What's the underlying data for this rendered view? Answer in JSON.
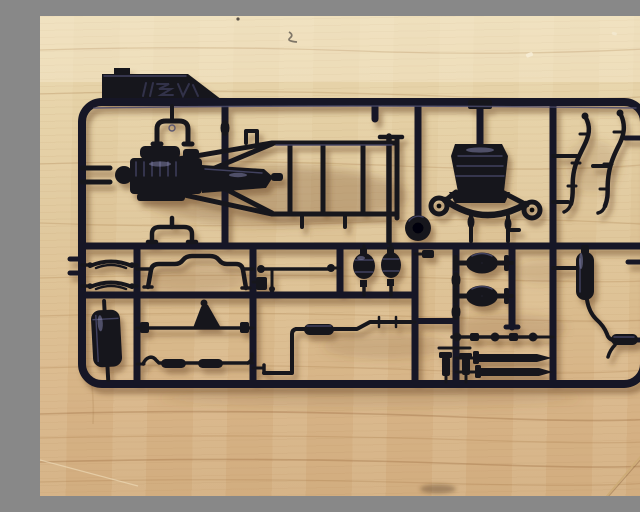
{
  "scene": {
    "type": "photograph",
    "description": "Top-down photo of a black injection-molded model kit sprue (parts runner) for a pickup truck chassis, lying on a light plywood workbench",
    "wood_surface": {
      "material": "plywood with horizontal grain",
      "base_color": "#dcc096",
      "grain_color": "#b98f58",
      "marks": {
        "pencil_squiggle": "small grey pencil squiggle near top centre",
        "tiny_dot": "tiny dark dot at top edge",
        "white_speck_1": "tiny white paint speck upper right",
        "white_speck_2": "tiny white speck near top right",
        "bottom_smudge": "dark smudge at bottom centre",
        "diagonal_crease": "diagonal grain crease in lower-right corner",
        "light_scratch": "faint light scratch in lower-left corner"
      }
    },
    "sprue": {
      "plastic_color": "#16161f",
      "highlight_color": "#4a4a6b",
      "frame": "rounded-rectangle outer runner with internal cross runners dividing part cells",
      "logo_tab": {
        "description": "molded manufacturer logo tab with stylized embossed italic lettering, same black plastic",
        "position": "top-left"
      },
      "parts": {
        "chassis_frame": "ladder chassis frame with crossmembers and diagonal braces",
        "engine_assembly": "engine block with ribbed head, intake and transmission tail",
        "spring_shackle_upper": "U-shaped spring shackle bracket above engine",
        "spring_shackle_lower": "lower shackle bracket near centre runner",
        "transfer_case": "transfer case box with looped crossmember ears and two lever pins",
        "diff_cover_dome": "round differential cover dome",
        "flex_pipe_left": "curved brake/fuel pipe with clamp stubs",
        "flex_pipe_right": "curved brake/fuel pipe with clamp stubs",
        "leaf_spring_1": "short leaf spring with eye ends",
        "leaf_spring_2": "short leaf spring with eye ends",
        "fuel_tank": "tall rounded fuel tank",
        "sway_bar": "stepped anti-roll sway bar",
        "tie_rod": "tie rod with ball ends and drop link",
        "hub_drum_1": "brake drum hub",
        "hub_drum_2": "brake drum hub",
        "track_bar_bracket": "track bar rod with triangular steering bracket",
        "drag_link": "drag link rod with two sleeve sections and curled ends",
        "exhaust_pipe": "zig-zag exhaust pipe with inline muffler section",
        "front_axle": "axle housing with differential pumpkin and end flanges",
        "rear_axle": "axle housing with differential pumpkin and end flanges",
        "shock_absorbers": "two spindle-shaped dampers molded along runner",
        "driveshaft": "driveshaft with universal-joint knuckles",
        "torsion_rod_1": "tapered steering/torsion rod",
        "torsion_rod_2": "tapered steering/torsion rod",
        "bolt_part_1": "small bolt / king-pin part",
        "bolt_part_2": "small bolt / king-pin part",
        "muffler_assembly": "muffler canister with curved tailpipe and resonator tip"
      }
    }
  }
}
